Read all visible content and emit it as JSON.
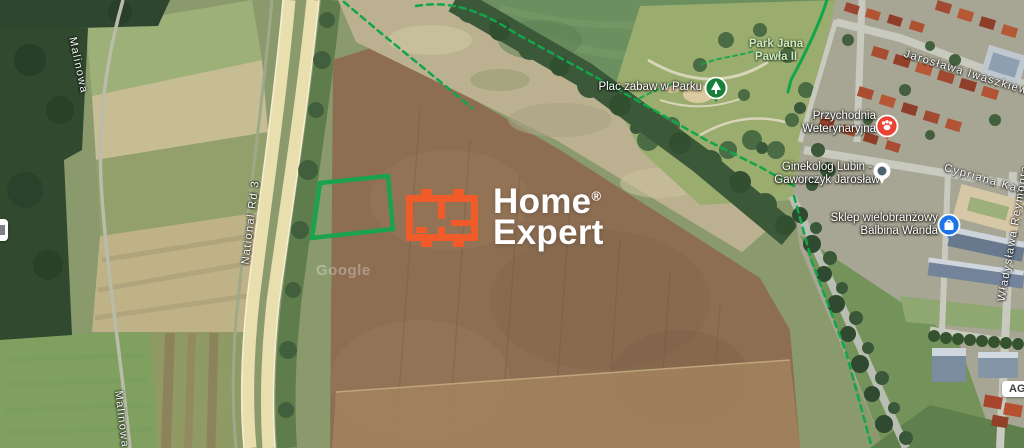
{
  "brand": {
    "name_line1": "Home",
    "registered_mark": "®",
    "name_line2": "Expert"
  },
  "streets": {
    "malinowa": "Malinowa",
    "malinowa_bottom": "Malinowa",
    "national_road": "National Rd 3",
    "iwaszkiewicza": "Jarosława Iwaszkiewicza",
    "norwida_partial": "Cypriana Kamila No",
    "reymonta": "Władysława Reymonta"
  },
  "pois": {
    "park": {
      "line1": "Park Jana",
      "line2": "Pawła II"
    },
    "playground": {
      "label": "Plac zabaw w Parku"
    },
    "vet": {
      "line1": "Przychodnia",
      "line2": "Weterynaryjna"
    },
    "gynecologist": {
      "line1": "Ginekolog Lubin -",
      "line2": "Gaworczyk Jarosław"
    },
    "shop": {
      "line1": "Sklep wielobranżowy",
      "line2": "Balbina Wanda"
    },
    "partial_poi": {
      "label": "AGE"
    }
  },
  "watermark": {
    "text": "Google"
  },
  "colors": {
    "brand_orange": "#f15a29",
    "parcel_outline": "#1aa24d",
    "route_green": "#12a64b",
    "marker_red": "#ea4335",
    "marker_blue": "#1c74e8",
    "marker_green": "#188038",
    "marker_slate": "#4c6472"
  }
}
